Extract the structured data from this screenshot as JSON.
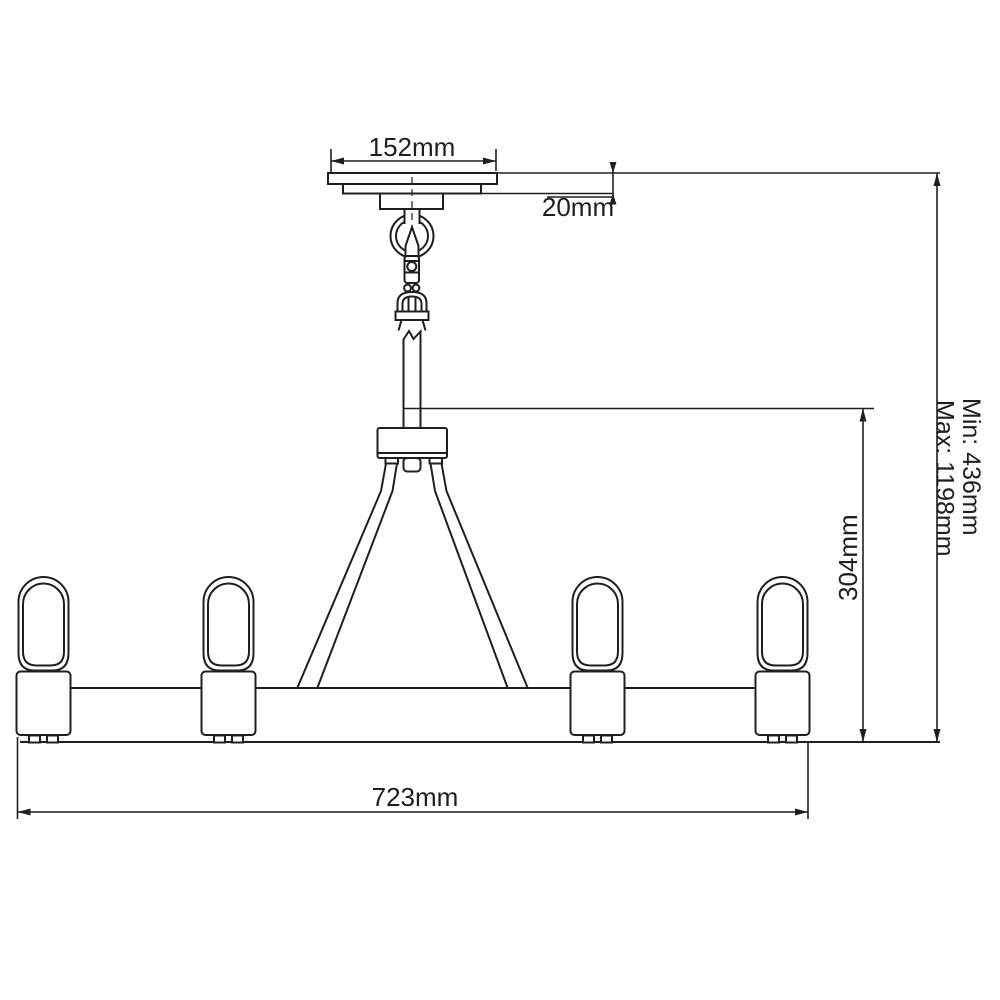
{
  "diagram": {
    "background_color": "#ffffff",
    "line_color": "#1f1f1f",
    "lamp_count": 4,
    "dimensions": {
      "canopy_width": "152mm",
      "canopy_height": "20mm",
      "body_height": "304mm",
      "bar_width": "723mm",
      "min_drop": "Min: 436mm",
      "max_drop": "Max: 1198mm"
    }
  }
}
